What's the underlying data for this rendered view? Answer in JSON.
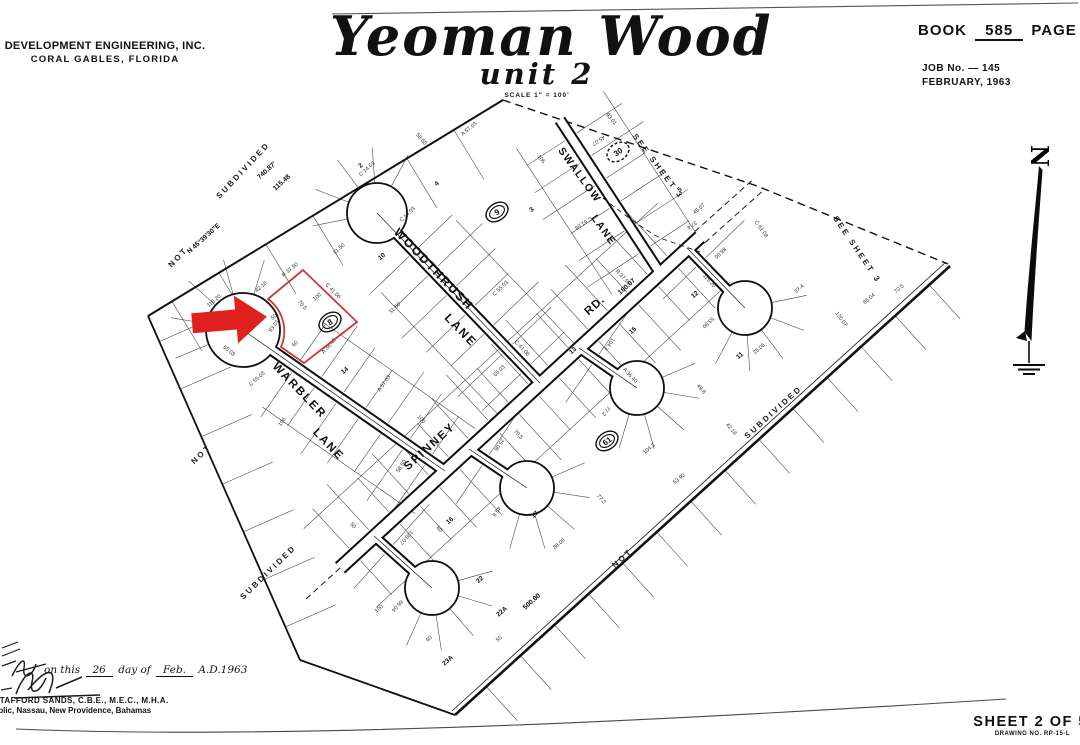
{
  "page": {
    "background": "#ffffff",
    "ink": "#111111",
    "arrow_red": "#e01f1f",
    "lot_outline_red": "#c63b36"
  },
  "header": {
    "firm_line1": "DEVELOPMENT ENGINEERING, INC.",
    "firm_line2": "CORAL GABLES, FLORIDA",
    "title": "Yeoman Wood",
    "subtitle": "unit 2",
    "scale_note": "SCALE 1\" = 100'",
    "book_label": "BOOK",
    "book_value": "585",
    "page_label": "PAGE",
    "page_value": "15",
    "job_no": "JOB No. — 145",
    "date": "FEBRUARY, 1963"
  },
  "compass": {
    "label": "N"
  },
  "titleblock_footer": {
    "sheet_label": "SHEET 2 OF 5",
    "drawing_no": "DRAWING NO. RP-15-L"
  },
  "certification": {
    "prefix": "on this",
    "day": "26",
    "of": "day of",
    "month": "Feb.",
    "year": "A.D.1963",
    "name": "STAFFORD SANDS, C.B.E., M.E.C., M.H.A.",
    "address": "Public, Nassau, New Providence, Bahamas"
  },
  "map": {
    "street_labels": [
      {
        "text": "WOODTHRUSH",
        "x": 431,
        "y": 272,
        "rot": 46,
        "size": 12,
        "ls": 2
      },
      {
        "text": "LANE",
        "x": 458,
        "y": 333,
        "rot": 46,
        "size": 12,
        "ls": 2
      },
      {
        "text": "SWALLOW",
        "x": 577,
        "y": 177,
        "rot": 54,
        "size": 10.5,
        "ls": 1.5
      },
      {
        "text": "LANE",
        "x": 601,
        "y": 232,
        "rot": 54,
        "size": 10.5,
        "ls": 1.5
      },
      {
        "text": "WARBLER",
        "x": 297,
        "y": 393,
        "rot": 46,
        "size": 11.5,
        "ls": 2
      },
      {
        "text": "LANE",
        "x": 326,
        "y": 447,
        "rot": 46,
        "size": 11.5,
        "ls": 2
      },
      {
        "text": "SPINNEY",
        "x": 432,
        "y": 449,
        "rot": -42,
        "size": 11.5,
        "ls": 2
      },
      {
        "text": "RD.",
        "x": 597,
        "y": 308,
        "rot": -42,
        "size": 11.5,
        "ls": 1
      }
    ],
    "area_labels": [
      {
        "text": "NOT",
        "x": 180,
        "y": 259,
        "rot": -47
      },
      {
        "text": "SUBDIVIDED",
        "x": 245,
        "y": 172,
        "rot": -47
      },
      {
        "text": "NOT",
        "x": 203,
        "y": 456,
        "rot": -44
      },
      {
        "text": "SUBDIVIDED",
        "x": 270,
        "y": 574,
        "rot": -44
      },
      {
        "text": "NOT",
        "x": 624,
        "y": 560,
        "rot": -42
      },
      {
        "text": "SUBDIVIDED",
        "x": 775,
        "y": 414,
        "rot": -42
      },
      {
        "text": "SEE  SHEET  3",
        "x": 656,
        "y": 168,
        "rot": 53
      },
      {
        "text": "SEE  SHEET  3",
        "x": 855,
        "y": 251,
        "rot": 56
      }
    ],
    "dim_labels": [
      {
        "text": "740.87'",
        "x": 268,
        "y": 172,
        "rot": -42
      },
      {
        "text": "115.48",
        "x": 283,
        "y": 184,
        "rot": -42
      },
      {
        "text": "N 45°39'30\"E",
        "x": 205,
        "y": 240,
        "rot": -42
      },
      {
        "text": "500.00",
        "x": 533,
        "y": 603,
        "rot": -42
      },
      {
        "text": "160.07",
        "x": 628,
        "y": 288,
        "rot": -42
      }
    ],
    "lot_numbers": [
      {
        "text": "10",
        "x": 383,
        "y": 258
      },
      {
        "text": "2",
        "x": 362,
        "y": 167
      },
      {
        "text": "4",
        "x": 438,
        "y": 185
      },
      {
        "text": "3",
        "x": 533,
        "y": 211
      },
      {
        "text": "5",
        "x": 681,
        "y": 191
      },
      {
        "text": "12",
        "x": 696,
        "y": 296
      },
      {
        "text": "15",
        "x": 634,
        "y": 332
      },
      {
        "text": "11",
        "x": 741,
        "y": 357
      },
      {
        "text": "13",
        "x": 574,
        "y": 352
      },
      {
        "text": "14",
        "x": 346,
        "y": 372
      },
      {
        "text": "16",
        "x": 451,
        "y": 522
      },
      {
        "text": "17",
        "x": 536,
        "y": 516
      },
      {
        "text": "22",
        "x": 481,
        "y": 581
      },
      {
        "text": "22A",
        "x": 503,
        "y": 613
      },
      {
        "text": "23A",
        "x": 449,
        "y": 662
      }
    ],
    "block_badges": [
      {
        "text": "9",
        "x": 497,
        "y": 212,
        "dashed": false
      },
      {
        "text": "8",
        "x": 330,
        "y": 322,
        "dashed": false
      },
      {
        "text": "30",
        "x": 618,
        "y": 152,
        "dashed": true
      },
      {
        "text": "61",
        "x": 607,
        "y": 441,
        "dashed": false
      }
    ],
    "noise_tokens": [
      "50",
      "60",
      "100",
      "70.5",
      "C 41.06",
      "A 36.40",
      "R 37.50",
      "115.20",
      "65.03",
      "C 55.03",
      "31.50",
      "C 14.03",
      "58.50",
      "A 57.03",
      "106",
      "93.01",
      "45.07",
      "C 61.08",
      "37.4",
      "120.07",
      "66.04",
      "25.06",
      "49.8",
      "104.3",
      "77.2",
      "88.06",
      "53.90",
      "42.18"
    ]
  }
}
